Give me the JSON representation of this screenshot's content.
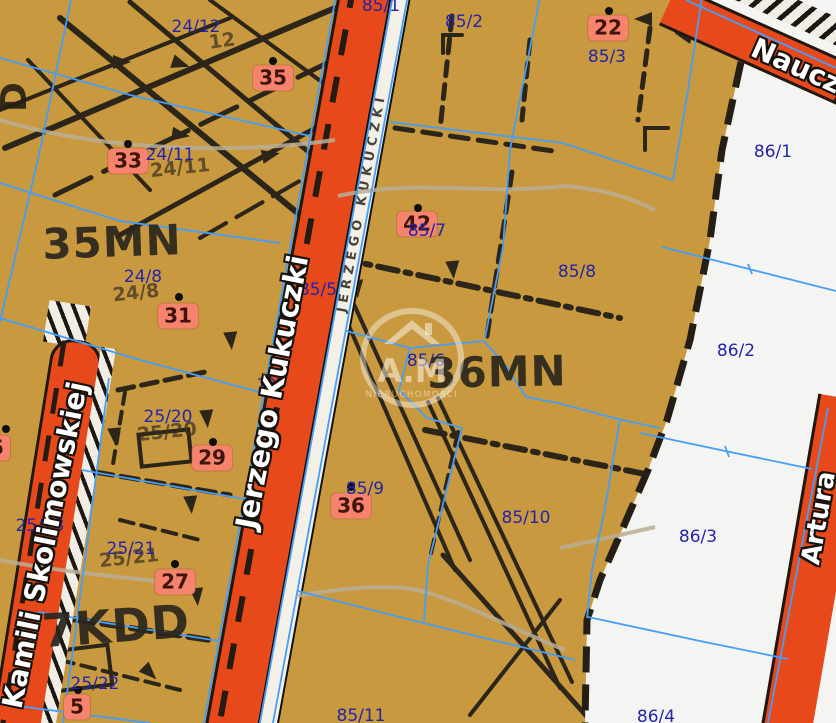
{
  "map": {
    "title": "zoning map viewer",
    "watermark": {
      "brand": "A.M",
      "subtitle": "NIERUCHOMOŚCI"
    },
    "colors": {
      "zone_fill": "#c8993e",
      "white_zone": "#f4f4f2",
      "road_orange": "#e8491b",
      "parcel_line_blue": "#459ef7",
      "parcel_text_navy": "#2424a8",
      "badge_bg": "#f5836e",
      "badge_text": "#401409",
      "zone_text": "#2b261c",
      "scan_ink": "#2c2519"
    },
    "zones": [
      {
        "label": "35MN",
        "x": 112,
        "y": 242,
        "size": 42,
        "rot": -2
      },
      {
        "label": "36MN",
        "x": 497,
        "y": 372,
        "size": 42,
        "rot": -1
      },
      {
        "label": "7KDD",
        "x": 116,
        "y": 626,
        "size": 46,
        "rot": -4
      }
    ],
    "streets": [
      {
        "name": "Jerzego Kukuczki",
        "x": 272,
        "y": 392,
        "rot": -79,
        "size": 29
      },
      {
        "name": "Kamili Skolimowskiej",
        "x": 45,
        "y": 545,
        "rot": -78.5,
        "size": 28
      },
      {
        "name": "Nauczy",
        "x": 753,
        "y": 30,
        "rot": 24,
        "size": 28,
        "anchor": "left"
      },
      {
        "name": "Artura",
        "x": 819,
        "y": 518,
        "rot": -80,
        "size": 26
      }
    ],
    "parcels": [
      {
        "label": "24/12",
        "x": 196,
        "y": 27
      },
      {
        "label": "85/1",
        "x": 381,
        "y": 6
      },
      {
        "label": "85/2",
        "x": 464,
        "y": 22
      },
      {
        "label": "85/3",
        "x": 607,
        "y": 57
      },
      {
        "label": "86/1",
        "x": 773,
        "y": 152
      },
      {
        "label": "24/11",
        "x": 170,
        "y": 155
      },
      {
        "label": "85/7",
        "x": 427,
        "y": 231
      },
      {
        "label": "85/8",
        "x": 577,
        "y": 272
      },
      {
        "label": "24/8",
        "x": 143,
        "y": 277
      },
      {
        "label": "85/5",
        "x": 318,
        "y": 290
      },
      {
        "label": "85/6",
        "x": 426,
        "y": 361
      },
      {
        "label": "86/2",
        "x": 736,
        "y": 351
      },
      {
        "label": "103",
        "x": 271,
        "y": 384,
        "size": 15
      },
      {
        "label": "25/20",
        "x": 168,
        "y": 417
      },
      {
        "label": "25/23",
        "x": 40,
        "y": 526
      },
      {
        "label": "85/9",
        "x": 365,
        "y": 489
      },
      {
        "label": "85/10",
        "x": 526,
        "y": 518
      },
      {
        "label": "86/3",
        "x": 698,
        "y": 537
      },
      {
        "label": "25/21",
        "x": 131,
        "y": 549
      },
      {
        "label": "25/22",
        "x": 95,
        "y": 684
      },
      {
        "label": "85/11",
        "x": 361,
        "y": 716
      },
      {
        "label": "86/4",
        "x": 656,
        "y": 717
      }
    ],
    "printed_scan_numbers": [
      {
        "label": "12",
        "x": 222,
        "y": 41,
        "rot": -8
      },
      {
        "label": "24/11",
        "x": 180,
        "y": 168,
        "rot": -6
      },
      {
        "label": "24/8",
        "x": 136,
        "y": 293,
        "rot": -6
      },
      {
        "label": "25/20",
        "x": 167,
        "y": 432,
        "rot": -6
      },
      {
        "label": "25/21",
        "x": 129,
        "y": 558,
        "rot": -6
      }
    ],
    "addresses": [
      {
        "label": "22",
        "x": 608,
        "y": 28,
        "dot_x": 609,
        "dot_y": 11
      },
      {
        "label": "35",
        "x": 273,
        "y": 78,
        "dot_x": 273,
        "dot_y": 61
      },
      {
        "label": "33",
        "x": 128,
        "y": 161,
        "dot_x": 128,
        "dot_y": 144
      },
      {
        "label": "31",
        "x": 178,
        "y": 316,
        "dot_x": 179,
        "dot_y": 297
      },
      {
        "label": "42",
        "x": 417,
        "y": 224,
        "dot_x": 418,
        "dot_y": 208
      },
      {
        "label": "29",
        "x": 212,
        "y": 458,
        "dot_x": 213,
        "dot_y": 442
      },
      {
        "label": "27",
        "x": 175,
        "y": 582,
        "dot_x": 175,
        "dot_y": 564
      },
      {
        "label": "36",
        "x": 351,
        "y": 506,
        "dot_x": 351,
        "dot_y": 487
      },
      {
        "label": "5",
        "x": 77,
        "y": 707,
        "dot_x": 78,
        "dot_y": 690
      },
      {
        "label": "5",
        "x": -3,
        "y": 448,
        "dot_x": 6,
        "dot_y": 429
      }
    ]
  }
}
